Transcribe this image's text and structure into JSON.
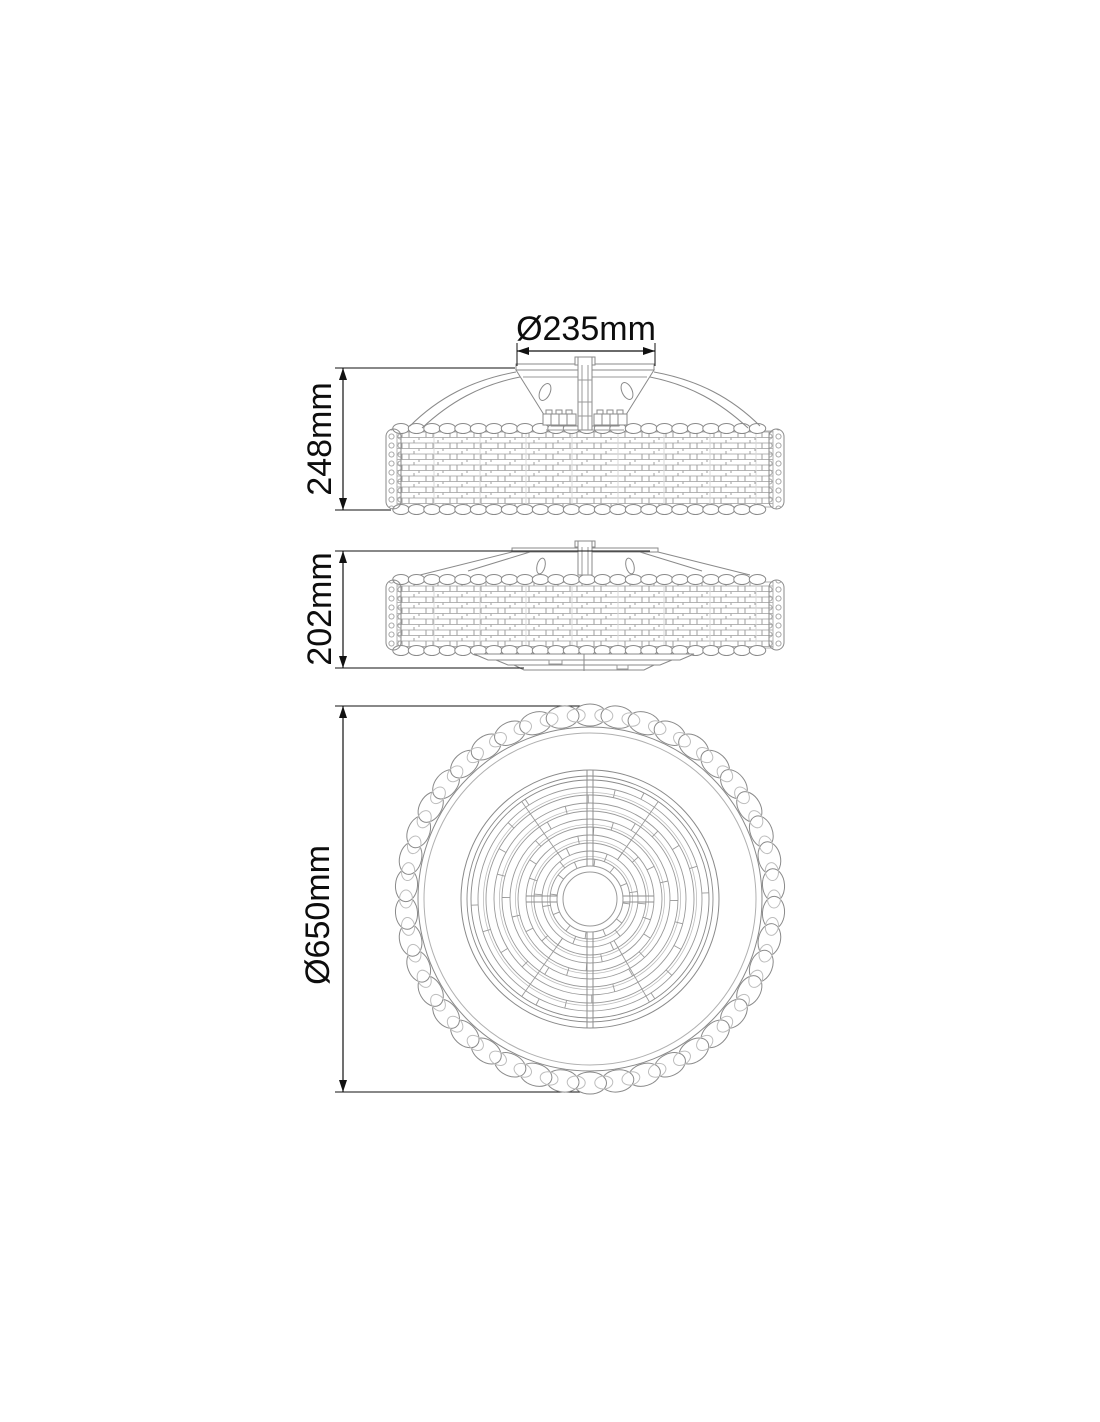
{
  "dimensions": {
    "mount_diameter": {
      "label": "Ø235mm"
    },
    "total_height": {
      "label": "248mm"
    },
    "body_height": {
      "label": "202mm"
    },
    "overall_diameter": {
      "label": "Ø650mm"
    }
  },
  "colors": {
    "background": "#ffffff",
    "dimension": "#111111",
    "line": "#8a8a8a",
    "texture": "#b0b0b0"
  }
}
